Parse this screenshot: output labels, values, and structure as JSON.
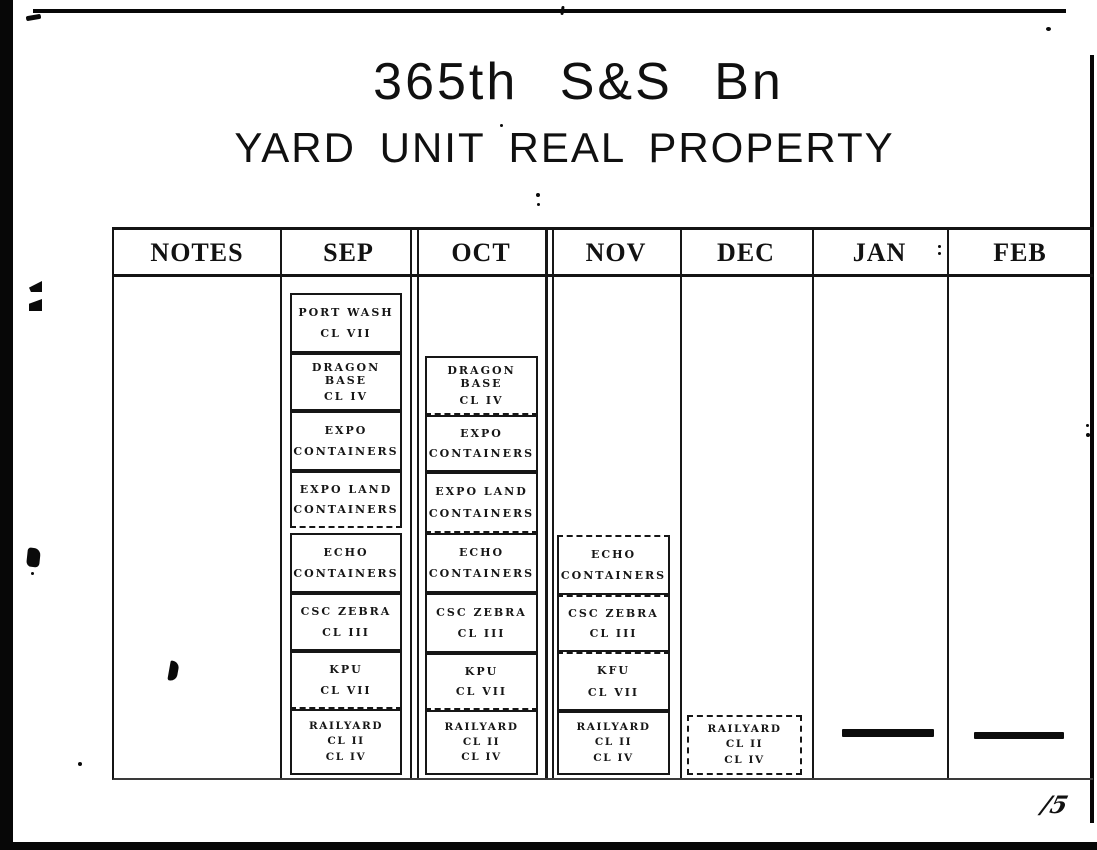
{
  "page": {
    "title": "365th S&S Bn",
    "subtitle": "YARD UNIT REAL PROPERTY",
    "page_number": "/5"
  },
  "table": {
    "columns": [
      "NOTES",
      "SEP",
      "OCT",
      "NOV",
      "DEC",
      "JAN",
      "FEB"
    ]
  },
  "boxes": {
    "sep": [
      {
        "lines": [
          "PORT WASH",
          "CL VII"
        ]
      },
      {
        "lines": [
          "DRAGON BASE",
          "CL IV"
        ]
      },
      {
        "lines": [
          "EXPO",
          "CONTAINERS"
        ]
      },
      {
        "lines": [
          "EXPO LAND",
          "CONTAINERS"
        ]
      },
      {
        "lines": [
          "ECHO",
          "CONTAINERS"
        ]
      },
      {
        "lines": [
          "CSC ZEBRA",
          "CL III"
        ]
      },
      {
        "lines": [
          "KPU",
          "CL VII"
        ]
      },
      {
        "lines": [
          "RAILYARD",
          "CL II",
          "CL IV"
        ]
      }
    ],
    "oct": [
      {
        "lines": [
          "DRAGON BASE",
          "CL IV"
        ]
      },
      {
        "lines": [
          "EXPO",
          "CONTAINERS"
        ]
      },
      {
        "lines": [
          "EXPO LAND",
          "CONTAINERS"
        ]
      },
      {
        "lines": [
          "ECHO",
          "CONTAINERS"
        ]
      },
      {
        "lines": [
          "CSC ZEBRA",
          "CL III"
        ]
      },
      {
        "lines": [
          "KPU",
          "CL VII"
        ]
      },
      {
        "lines": [
          "RAILYARD",
          "CL II",
          "CL IV"
        ]
      }
    ],
    "nov": [
      {
        "lines": [
          "ECHO",
          "CONTAINERS"
        ]
      },
      {
        "lines": [
          "CSC ZEBRA",
          "CL III"
        ]
      },
      {
        "lines": [
          "KFU",
          "CL VII"
        ]
      },
      {
        "lines": [
          "RAILYARD",
          "CL II",
          "CL IV"
        ]
      }
    ],
    "dec": [
      {
        "lines": [
          "RAILYARD",
          "CL II",
          "CL IV"
        ]
      }
    ]
  },
  "colors": {
    "ink": "#141414",
    "paper": "#ffffff"
  }
}
